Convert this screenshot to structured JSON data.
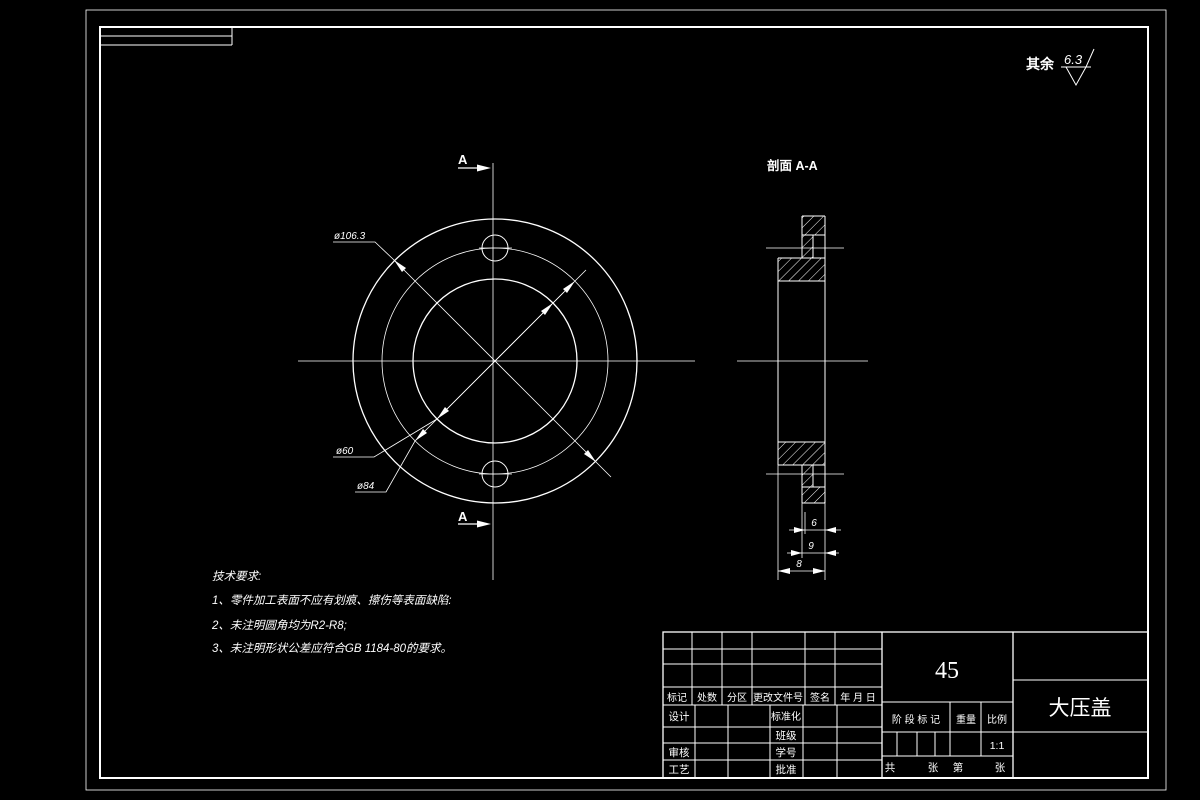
{
  "colors": {
    "background": "#000000",
    "line": "#ffffff"
  },
  "surface_note": {
    "prefix": "其余",
    "value": "6.3"
  },
  "views": {
    "section_title": "剖面 A-A",
    "cut_label_top": "A",
    "cut_label_bottom": "A"
  },
  "dimensions": {
    "outer_dia": "ø106.3",
    "bore_dia": "ø60",
    "bolt_circle_dia": "ø84",
    "boss_thickness": "6",
    "plate_thickness": "9",
    "total_thickness": "8"
  },
  "tech_requirements": {
    "title": "技术要求:",
    "item1": "1、零件加工表面不应有划痕、擦伤等表面缺陷:",
    "item2": "2、未注明圆角均为R2-R8;",
    "item3": "3、未注明形状公差应符合GB 1184-80的要求。"
  },
  "title_block": {
    "header": {
      "mark": "标记",
      "count": "处数",
      "zone": "分区",
      "change_file_no": "更改文件号",
      "signature": "签名",
      "date": "年 月 日"
    },
    "left": {
      "design": "设计",
      "check": "审核",
      "process": "工艺"
    },
    "middle": {
      "standardization": "标准化",
      "class": "班级",
      "student_no": "学号",
      "approve": "批准"
    },
    "material": "45",
    "stage_mark": "阶 段 标 记",
    "weight": "重量",
    "scale": "比例",
    "scale_value": "1:1",
    "sheets": {
      "total_label": "共",
      "sheet_unit_1": "张",
      "index_label": "第",
      "sheet_unit_2": "张"
    },
    "part_name": "大压盖"
  }
}
